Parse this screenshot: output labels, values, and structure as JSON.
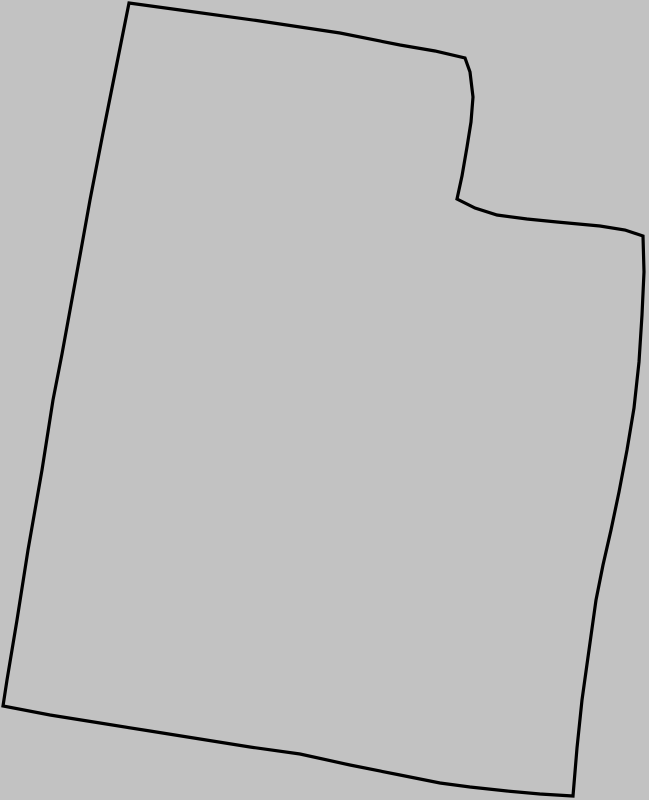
{
  "canvas": {
    "width": 649,
    "height": 800,
    "background_color": "#c2c2c2"
  },
  "outline": {
    "name": "utah-state-outline",
    "stroke_color": "#000000",
    "stroke_width": 3.2,
    "fill": "none",
    "points": [
      [
        129,
        3
      ],
      [
        180,
        10
      ],
      [
        260,
        21
      ],
      [
        340,
        33
      ],
      [
        400,
        45
      ],
      [
        435,
        51
      ],
      [
        465,
        58
      ],
      [
        470,
        72
      ],
      [
        473,
        97
      ],
      [
        471,
        122
      ],
      [
        467,
        147
      ],
      [
        462,
        176
      ],
      [
        457,
        199
      ],
      [
        475,
        208
      ],
      [
        497,
        215
      ],
      [
        527,
        219
      ],
      [
        557,
        222
      ],
      [
        600,
        226
      ],
      [
        625,
        230
      ],
      [
        643,
        236
      ],
      [
        644,
        272
      ],
      [
        642,
        315
      ],
      [
        639,
        362
      ],
      [
        634,
        408
      ],
      [
        627,
        450
      ],
      [
        619,
        492
      ],
      [
        611,
        530
      ],
      [
        603,
        565
      ],
      [
        596,
        600
      ],
      [
        589,
        650
      ],
      [
        582,
        700
      ],
      [
        577,
        748
      ],
      [
        573,
        796
      ],
      [
        540,
        794
      ],
      [
        507,
        791
      ],
      [
        470,
        787
      ],
      [
        440,
        783
      ],
      [
        400,
        775
      ],
      [
        350,
        765
      ],
      [
        300,
        754
      ],
      [
        250,
        747
      ],
      [
        200,
        739
      ],
      [
        150,
        731
      ],
      [
        100,
        723
      ],
      [
        50,
        715
      ],
      [
        3,
        706
      ],
      [
        7,
        680
      ],
      [
        17,
        620
      ],
      [
        28,
        550
      ],
      [
        42,
        470
      ],
      [
        53,
        400
      ],
      [
        62,
        354
      ],
      [
        81,
        250
      ],
      [
        90,
        200
      ],
      [
        103,
        133
      ],
      [
        116,
        68
      ]
    ]
  }
}
